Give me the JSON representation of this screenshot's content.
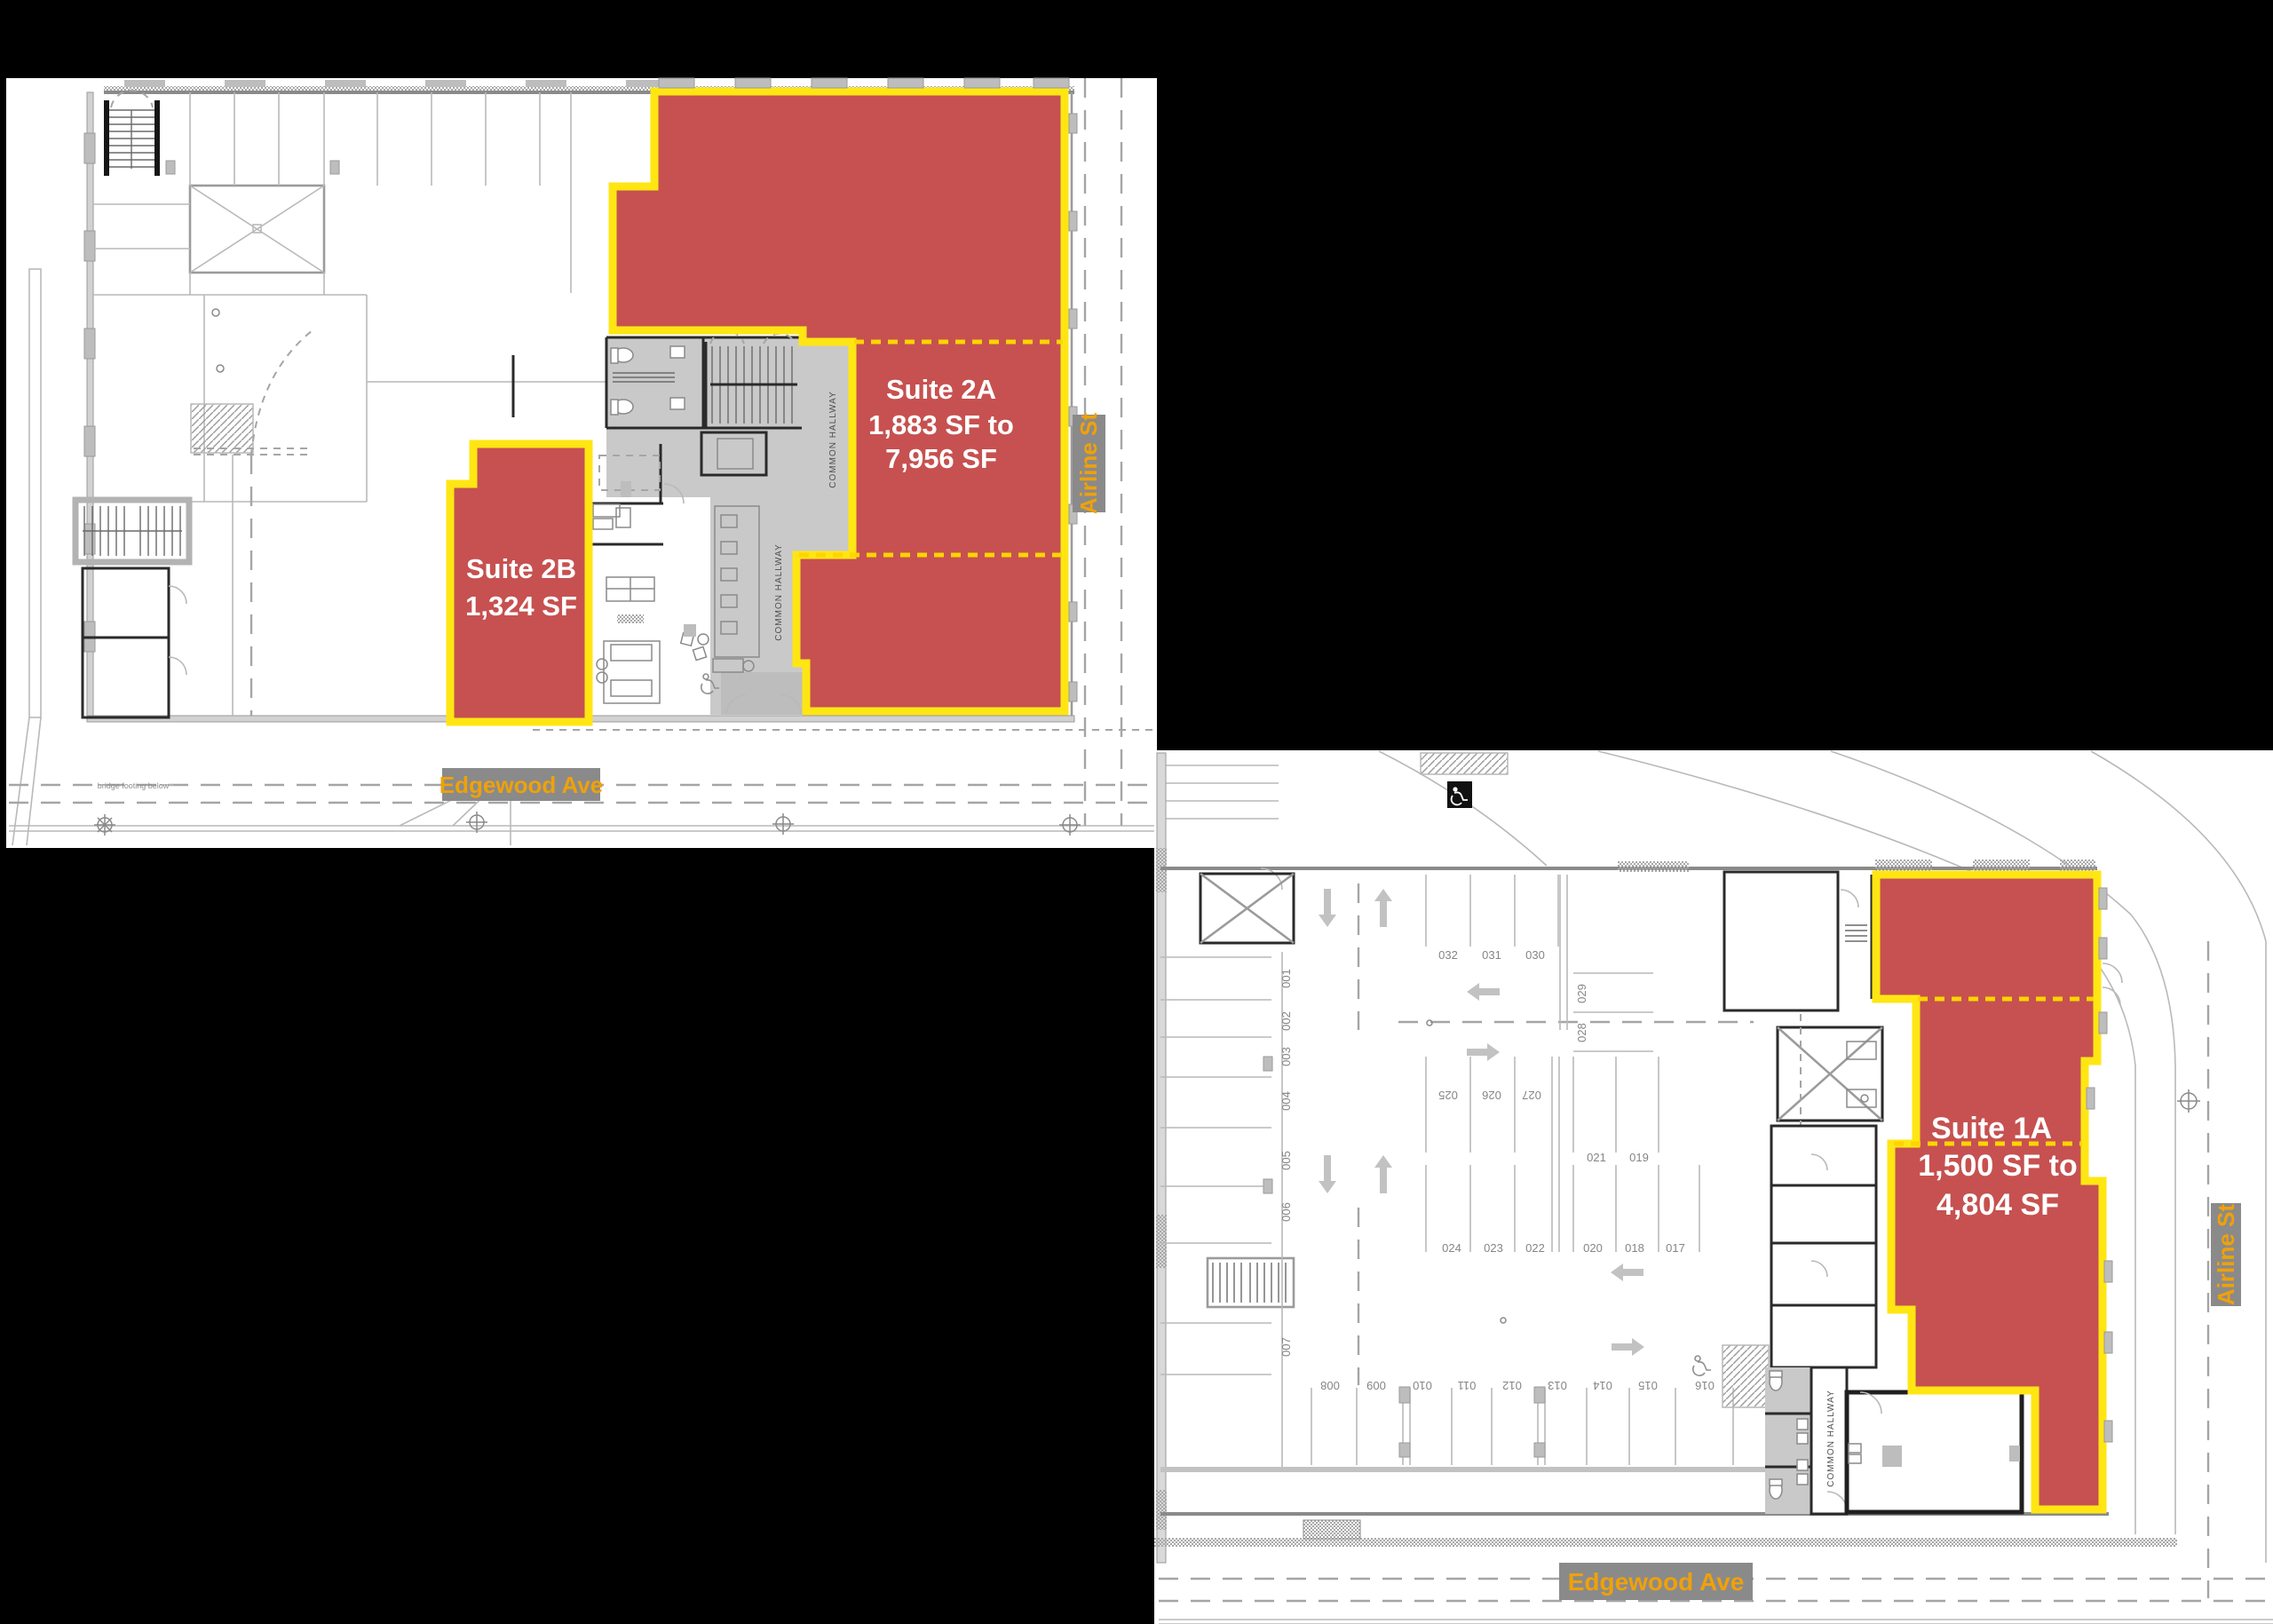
{
  "document": {
    "type": "leasing floor plan exhibit",
    "background": "#000000"
  },
  "colors": {
    "suite_fill": "#c65150",
    "suite_border": "#ffe613",
    "suite_divider_dash": "#ffd400",
    "street_label_bg": "#8a8a8a",
    "street_label_text": "#efa10a",
    "suite_text": "#ffffff",
    "plan_line": "#b9b9b9"
  },
  "icons": {
    "accessible_parking": "wheelchair-icon"
  },
  "plan2": {
    "name": "second-floor-plan",
    "suite2a": {
      "name": "Suite 2A",
      "range_line1": "1,883 SF to",
      "range_line2": "7,956 SF"
    },
    "suite2b": {
      "name": "Suite 2B",
      "area": "1,324 SF"
    },
    "street_right": "Airline St",
    "street_bottom": "Edgewood Ave",
    "hallway_label": "COMMON HALLWAY",
    "note_bridge": "bridge footing below"
  },
  "plan1": {
    "name": "first-floor-parking-plan",
    "suite1a": {
      "name": "Suite 1A",
      "range_line1": "1,500 SF to",
      "range_line2": "4,804 SF"
    },
    "street_right": "Airline St",
    "street_bottom": "Edgewood Ave",
    "hallway_label": "COMMON HALLWAY",
    "parking": {
      "top_row": [
        "032",
        "031",
        "030"
      ],
      "left_column": [
        "001",
        "002",
        "003",
        "004",
        "005",
        "006",
        "007"
      ],
      "side_pair": [
        "029",
        "028"
      ],
      "mid_flipped": [
        "025",
        "026",
        "027"
      ],
      "mid_upper": [
        "021",
        "019"
      ],
      "mid_lower": [
        "024",
        "023",
        "022",
        "020",
        "018",
        "017"
      ],
      "bottom_row": [
        "008",
        "009",
        "010",
        "011",
        "012",
        "013",
        "014",
        "015",
        "016"
      ]
    }
  }
}
